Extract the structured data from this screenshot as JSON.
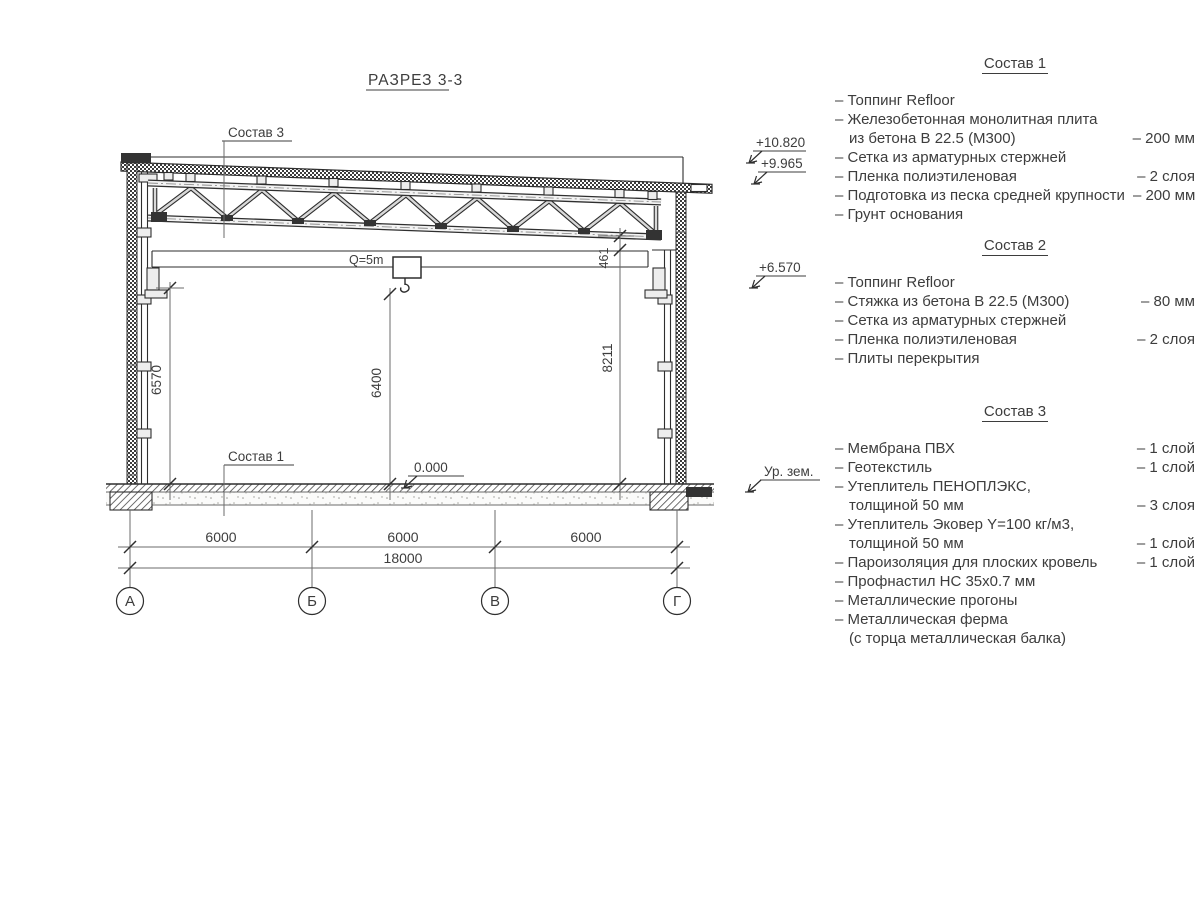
{
  "section": {
    "title": "РАЗРЕЗ 3-3",
    "callout_roof": "Состав 3",
    "callout_floor": "Состав 1",
    "crane_label": "Q=5m",
    "zero_level": "0.000",
    "dim_left": "6570",
    "dim_hook": "6400",
    "dim_right": "8211",
    "dim_gap": "461",
    "spans": [
      "6000",
      "6000",
      "6000"
    ],
    "total": "18000",
    "axes": [
      "А",
      "Б",
      "В",
      "Г"
    ]
  },
  "elevations": {
    "roof_high": "+10.820",
    "roof_low": "+9.965",
    "crane": "+6.570",
    "ground": "Ур. зем."
  },
  "compositions": [
    {
      "title": "Состав 1",
      "rows": [
        {
          "t": "– Топпинг Refloor",
          "v": ""
        },
        {
          "t": "– Железобетонная  монолитная плита",
          "v": ""
        },
        {
          "t": "из бетона В 22.5 (М300)",
          "v": "– 200 мм"
        },
        {
          "t": "– Сетка из арматурных стержней",
          "v": ""
        },
        {
          "t": "– Пленка полиэтиленовая",
          "v": "–  2 слоя"
        },
        {
          "t": "– Подготовка из песка средней крупности",
          "v": "– 200 мм"
        },
        {
          "t": "– Грунт основания",
          "v": ""
        }
      ]
    },
    {
      "title": "Состав 2",
      "rows": [
        {
          "t": "– Топпинг Refloor",
          "v": ""
        },
        {
          "t": "– Стяжка из бетона В 22.5 (М300)",
          "v": "– 80 мм"
        },
        {
          "t": "– Сетка из арматурных стержней",
          "v": ""
        },
        {
          "t": "– Пленка полиэтиленовая",
          "v": "–  2 слоя"
        },
        {
          "t": "– Плиты перекрытия",
          "v": ""
        }
      ]
    },
    {
      "title": "Состав 3",
      "rows": [
        {
          "t": "– Мембрана ПВХ",
          "v": "– 1 слой"
        },
        {
          "t": "– Геотекстиль",
          "v": "– 1 слой"
        },
        {
          "t": "– Утеплитель ПЕНОПЛЭКС,",
          "v": ""
        },
        {
          "t": "толщиной 50 мм",
          "v": "– 3 слоя"
        },
        {
          "t": "– Утеплитель Эковер Y=100 кг/м3,",
          "v": ""
        },
        {
          "t": "толщиной 50 мм",
          "v": "– 1 слой"
        },
        {
          "t": "– Пароизоляция для плоских кровель",
          "v": "– 1 слой"
        },
        {
          "t": "– Профнастил НС 35х0.7 мм",
          "v": ""
        },
        {
          "t": "– Металлические прогоны",
          "v": ""
        },
        {
          "t": "– Металлическая ферма",
          "v": ""
        },
        {
          "t": "(с торца металлическая балка)",
          "v": ""
        }
      ]
    }
  ]
}
